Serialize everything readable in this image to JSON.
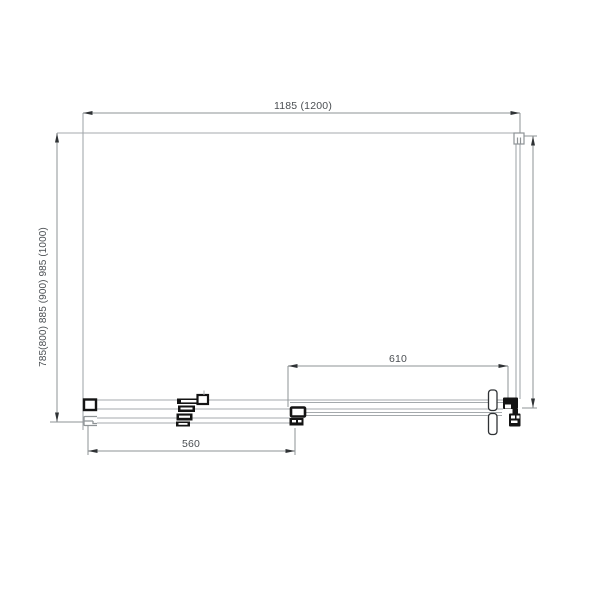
{
  "drawing": {
    "type": "shower-enclosure-plan-view-technical-drawing",
    "labels": {
      "top_width": "1185 (1200)",
      "left_depth": "785(800) 885 (900) 985 (1000)",
      "door_opening_width": "610",
      "panel_width": "560"
    },
    "colors": {
      "line": "#a4a9ac",
      "dimension": "#8e9396",
      "arrow": "#2f3235",
      "text": "#4a4e52",
      "component": "#141414",
      "clip": "#8e9396",
      "background": "#ffffff"
    }
  }
}
